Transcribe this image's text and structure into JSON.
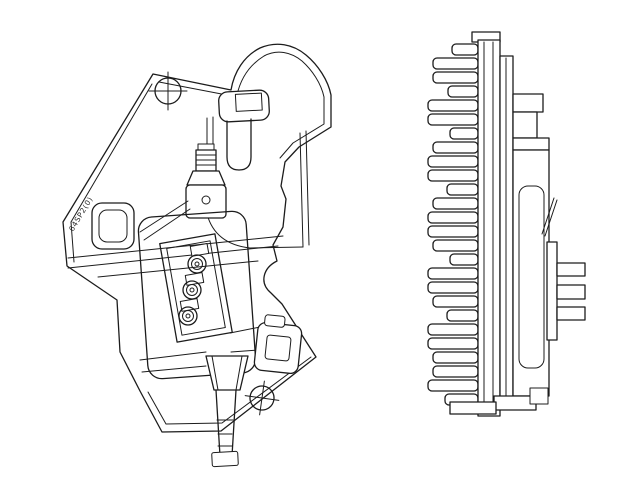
{
  "figure": {
    "marking_text": "64SP2(0)",
    "view_count": "2",
    "colors": {
      "line_color": "#1c1c1c",
      "background": "#ffffff"
    }
  }
}
